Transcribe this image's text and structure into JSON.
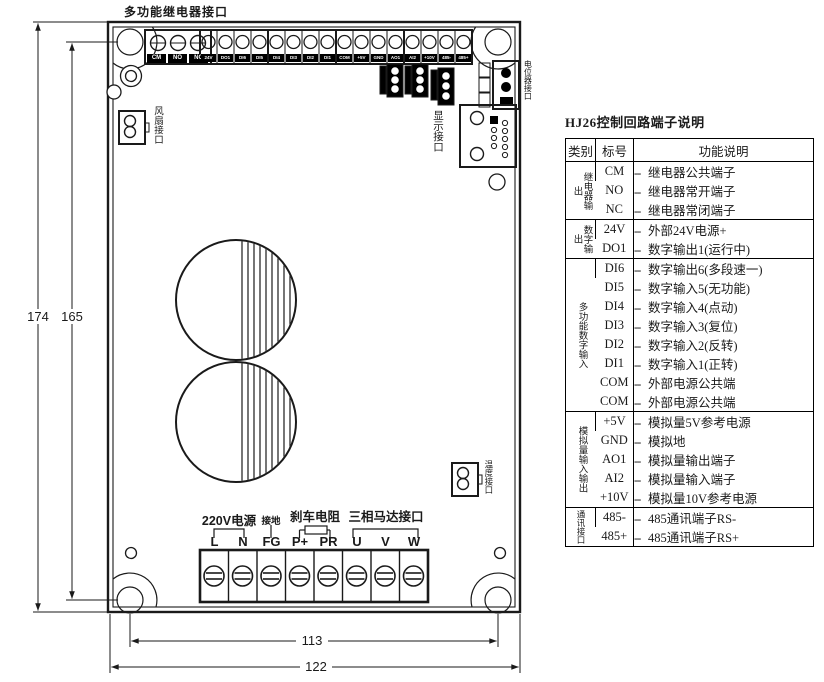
{
  "board": {
    "top_label": "多功能继电器接口",
    "relay_terminals": [
      "CM",
      "NO",
      "NC"
    ],
    "strip_terminals": [
      "24V",
      "DO1",
      "DI6",
      "DI5",
      "DI4",
      "DI3",
      "DI2",
      "DI1",
      "COM",
      "+5V",
      "GND",
      "AO1",
      "AI2",
      "+10V",
      "485-",
      "485+"
    ],
    "connectors": {
      "fan": "风扇接口",
      "display": "显示接口",
      "potentiometer": "电位器接口",
      "temperature": "温度接口"
    },
    "bottom": {
      "power_label": "220V电源",
      "ground_label": "接地",
      "brake_label": "刹车电阻",
      "motor_label": "三相马达接口",
      "terminals": [
        "L",
        "N",
        "FG",
        "P+",
        "PR",
        "U",
        "V",
        "W"
      ]
    },
    "dimensions": {
      "height_outer": "174",
      "height_holes": "165",
      "width_holes": "113",
      "width_outer": "122"
    }
  },
  "table": {
    "title": "HJ26控制回路端子说明",
    "headers": [
      "类别",
      "标号",
      "功能说明"
    ],
    "dash": "--",
    "groups": [
      {
        "category": "继电器输出",
        "rows": [
          [
            "CM",
            "继电器公共端子"
          ],
          [
            "NO",
            "继电器常开端子"
          ],
          [
            "NC",
            "继电器常闭端子"
          ]
        ]
      },
      {
        "category": "数字输出",
        "rows": [
          [
            "24V",
            "外部24V电源+"
          ],
          [
            "DO1",
            "数字输出1(运行中)"
          ]
        ]
      },
      {
        "category": "多功能数字输入",
        "rows": [
          [
            "DI6",
            "数字输出6(多段速一)"
          ],
          [
            "DI5",
            "数字输入5(无功能)"
          ],
          [
            "DI4",
            "数字输入4(点动)"
          ],
          [
            "DI3",
            "数字输入3(复位)"
          ],
          [
            "DI2",
            "数字输入2(反转)"
          ],
          [
            "DI1",
            "数字输入1(正转)"
          ],
          [
            "COM",
            "外部电源公共端"
          ],
          [
            "COM",
            "外部电源公共端"
          ]
        ]
      },
      {
        "category": "模拟量输入输出",
        "rows": [
          [
            "+5V",
            "模拟量5V参考电源"
          ],
          [
            "GND",
            "模拟地"
          ],
          [
            "AO1",
            "模拟量输出端子"
          ],
          [
            "AI2",
            "模拟量输入端子"
          ],
          [
            "+10V",
            "模拟量10V参考电源"
          ]
        ]
      },
      {
        "category": "通讯接口",
        "rows": [
          [
            "485-",
            "485通讯端子RS-"
          ],
          [
            "485+",
            "485通讯端子RS+"
          ]
        ]
      }
    ]
  }
}
